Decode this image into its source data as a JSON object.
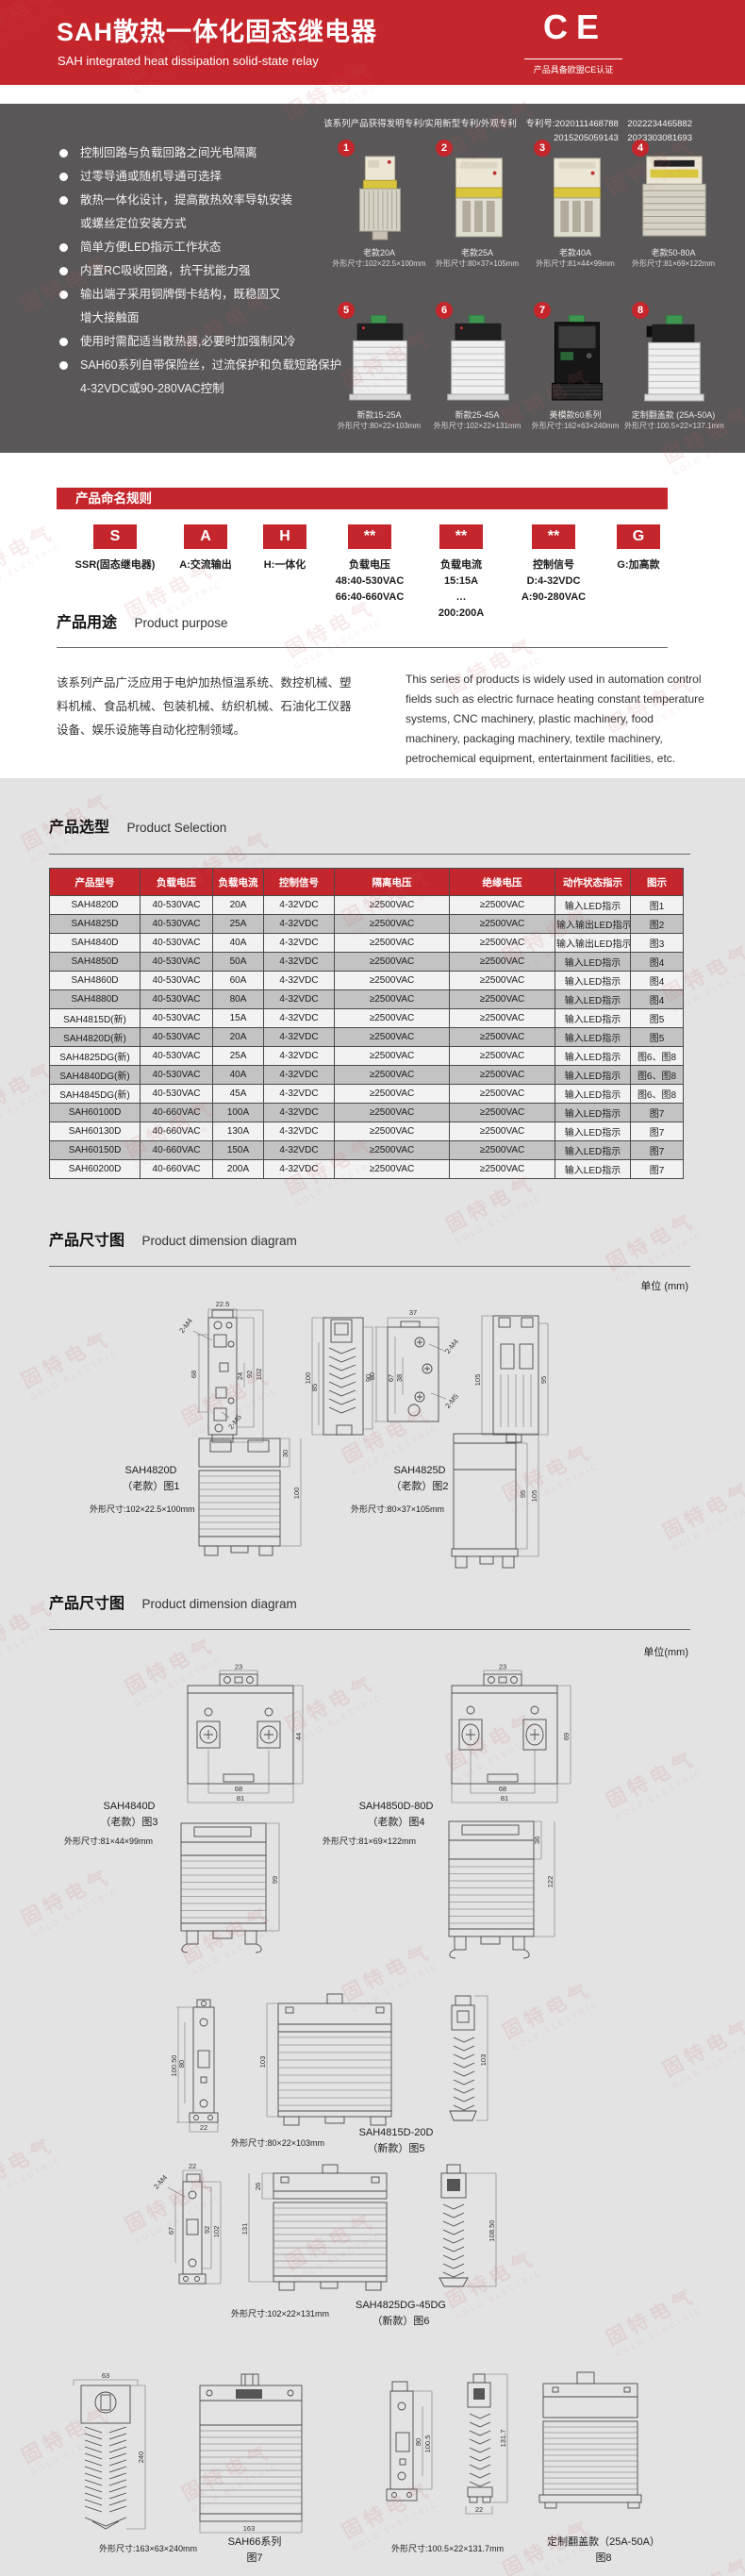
{
  "accent_color": "#c4262c",
  "dark_color": "#595757",
  "watermark": {
    "zh": "固特电气",
    "en": "GOLD ELECTRIC"
  },
  "header": {
    "title": "SAH散热一体化固态继电器",
    "subtitle": "SAH integrated heat dissipation solid-state relay",
    "ce_mark": "CE",
    "ce_note": "产品具备欧盟CE认证"
  },
  "features": {
    "patent_line1": "该系列产品获得发明专利/实用新型专利/外观专利　专利号:2020111468788　2022234465882",
    "patent_line2": "2015205059143　2023303081693",
    "lines": [
      {
        "bullet": true,
        "text": "控制回路与负载回路之间光电隔离"
      },
      {
        "bullet": true,
        "text": "过零导通或随机导通可选择"
      },
      {
        "bullet": true,
        "text": "散热一体化设计，提高散热效率导轨安装"
      },
      {
        "bullet": false,
        "text": "或螺丝定位安装方式"
      },
      {
        "bullet": true,
        "text": "简单方便LED指示工作状态"
      },
      {
        "bullet": true,
        "text": "内置RC吸收回路，抗干扰能力强"
      },
      {
        "bullet": true,
        "text": "输出端子采用铜牌倒卡结构，既稳固又"
      },
      {
        "bullet": false,
        "text": "增大接触面"
      },
      {
        "bullet": true,
        "text": "使用时需配适当散热器,必要时加强制风冷"
      },
      {
        "bullet": true,
        "text": "SAH60系列自带保险丝，过流保护和负载短路保护"
      },
      {
        "bullet": false,
        "text": "4-32VDC或90-280VAC控制"
      }
    ],
    "products": [
      {
        "num": "1",
        "name": "老款20A",
        "size": "外形尺寸:102×22.5×100mm",
        "image": "old-narrow-relay"
      },
      {
        "num": "2",
        "name": "老款25A",
        "size": "外形尺寸:80×37×105mm",
        "image": "old-box-relay"
      },
      {
        "num": "3",
        "name": "老款40A",
        "size": "外形尺寸:81×44×99mm",
        "image": "old-box-relay"
      },
      {
        "num": "4",
        "name": "老款50-80A",
        "size": "外形尺寸:81×69×122mm",
        "image": "old-wide-relay"
      },
      {
        "num": "5",
        "name": "新款15-25A",
        "size": "外形尺寸:80×22×103mm",
        "image": "new-fin-relay"
      },
      {
        "num": "6",
        "name": "新款25-45A",
        "size": "外形尺寸:102×22×131mm",
        "image": "new-fin-relay"
      },
      {
        "num": "7",
        "name": "美模款60系列",
        "size": "外形尺寸:162×63×240mm",
        "image": "module-relay"
      },
      {
        "num": "8",
        "name": "定制翻盖款 (25A-50A)",
        "size": "外形尺寸:100.5×22×137.1mm",
        "image": "flip-relay"
      }
    ]
  },
  "naming": {
    "banner": "产品命名规则",
    "parts": [
      {
        "code": "S",
        "lines": [
          "SSR(固态继电器)"
        ]
      },
      {
        "code": "A",
        "lines": [
          "A:交流输出"
        ]
      },
      {
        "code": "H",
        "lines": [
          "H:一体化"
        ]
      },
      {
        "code": "**",
        "lines": [
          "负载电压",
          "48:40-530VAC",
          "66:40-660VAC"
        ]
      },
      {
        "code": "**",
        "lines": [
          "负载电流",
          "15:15A",
          "…",
          "200:200A"
        ]
      },
      {
        "code": "**",
        "lines": [
          "控制信号",
          "D:4-32VDC",
          "A:90-280VAC"
        ]
      },
      {
        "code": "G",
        "lines": [
          "G:加高款"
        ]
      }
    ]
  },
  "purpose": {
    "title_zh": "产品用途",
    "title_en": "Product purpose",
    "text_zh": "该系列产品广泛应用于电炉加热恒温系统、数控机械、塑料机械、食品机械、包装机械、纺织机械、石油化工仪器设备、娱乐设施等自动化控制领域。",
    "text_en": "This series of products is widely used in automation control fields such as electric furnace heating constant temperature systems, CNC machinery, plastic machinery, food machinery, packaging machinery, textile machinery, petrochemical equipment, entertainment facilities, etc."
  },
  "selection": {
    "title_zh": "产品选型",
    "title_en": "Product Selection",
    "headers": [
      "产品型号",
      "负载电压",
      "负载电流",
      "控制信号",
      "隔离电压",
      "绝缘电压",
      "动作状态指示",
      "图示"
    ],
    "rows": [
      [
        "SAH4820D",
        "40-530VAC",
        "20A",
        "4-32VDC",
        "≥2500VAC",
        "≥2500VAC",
        "输入LED指示",
        "图1"
      ],
      [
        "SAH4825D",
        "40-530VAC",
        "25A",
        "4-32VDC",
        "≥2500VAC",
        "≥2500VAC",
        "输入输出LED指示",
        "图2"
      ],
      [
        "SAH4840D",
        "40-530VAC",
        "40A",
        "4-32VDC",
        "≥2500VAC",
        "≥2500VAC",
        "输入输出LED指示",
        "图3"
      ],
      [
        "SAH4850D",
        "40-530VAC",
        "50A",
        "4-32VDC",
        "≥2500VAC",
        "≥2500VAC",
        "输入LED指示",
        "图4"
      ],
      [
        "SAH4860D",
        "40-530VAC",
        "60A",
        "4-32VDC",
        "≥2500VAC",
        "≥2500VAC",
        "输入LED指示",
        "图4"
      ],
      [
        "SAH4880D",
        "40-530VAC",
        "80A",
        "4-32VDC",
        "≥2500VAC",
        "≥2500VAC",
        "输入LED指示",
        "图4"
      ],
      [
        "SAH4815D(新)",
        "40-530VAC",
        "15A",
        "4-32VDC",
        "≥2500VAC",
        "≥2500VAC",
        "输入LED指示",
        "图5"
      ],
      [
        "SAH4820D(新)",
        "40-530VAC",
        "20A",
        "4-32VDC",
        "≥2500VAC",
        "≥2500VAC",
        "输入LED指示",
        "图5"
      ],
      [
        "SAH4825DG(新)",
        "40-530VAC",
        "25A",
        "4-32VDC",
        "≥2500VAC",
        "≥2500VAC",
        "输入LED指示",
        "图6、图8"
      ],
      [
        "SAH4840DG(新)",
        "40-530VAC",
        "40A",
        "4-32VDC",
        "≥2500VAC",
        "≥2500VAC",
        "输入LED指示",
        "图6、图8"
      ],
      [
        "SAH4845DG(新)",
        "40-530VAC",
        "45A",
        "4-32VDC",
        "≥2500VAC",
        "≥2500VAC",
        "输入LED指示",
        "图6、图8"
      ],
      [
        "SAH60100D",
        "40-660VAC",
        "100A",
        "4-32VDC",
        "≥2500VAC",
        "≥2500VAC",
        "输入LED指示",
        "图7"
      ],
      [
        "SAH60130D",
        "40-660VAC",
        "130A",
        "4-32VDC",
        "≥2500VAC",
        "≥2500VAC",
        "输入LED指示",
        "图7"
      ],
      [
        "SAH60150D",
        "40-660VAC",
        "150A",
        "4-32VDC",
        "≥2500VAC",
        "≥2500VAC",
        "输入LED指示",
        "图7"
      ],
      [
        "SAH60200D",
        "40-660VAC",
        "200A",
        "4-32VDC",
        "≥2500VAC",
        "≥2500VAC",
        "输入LED指示",
        "图7"
      ]
    ]
  },
  "dims1": {
    "title_zh": "产品尺寸图",
    "title_en": "Product dimension diagram",
    "unit": "单位 (mm)",
    "fig1": {
      "model": "SAH4820D",
      "variant": "（老款）图1",
      "size": "外形尺寸:102×22.5×100mm",
      "labels": [
        "22.5",
        "2-M4",
        "68",
        "24",
        "92",
        "102",
        "2-M5",
        "100",
        "85",
        "90",
        "30",
        "100"
      ]
    },
    "fig2": {
      "model": "SAH4825D",
      "variant": "（老款）图2",
      "size": "外形尺寸:80×37×105mm",
      "labels": [
        "37",
        "2-M4",
        "80",
        "67",
        "38",
        "2-M5",
        "105",
        "95",
        "95",
        "105"
      ]
    }
  },
  "dims2": {
    "title_zh": "产品尺寸图",
    "title_en": "Product dimension diagram",
    "unit": "单位(mm)",
    "fig3": {
      "model": "SAH4840D",
      "variant": "（老款）图3",
      "size": "外形尺寸:81×44×99mm",
      "labels": [
        "23",
        "44",
        "68",
        "81",
        "99"
      ]
    },
    "fig4": {
      "model": "SAH4850D-80D",
      "variant": "（老款）图4",
      "size": "外形尺寸:81×69×122mm",
      "labels": [
        "23",
        "69",
        "68",
        "81",
        "36",
        "122"
      ]
    },
    "fig5": {
      "model": "SAH4815D-20D",
      "variant": "（新款）图5",
      "size": "外形尺寸:80×22×103mm",
      "labels": [
        "100.50",
        "80",
        "22",
        "103",
        "103"
      ]
    },
    "fig6": {
      "model": "SAH4825DG-45DG",
      "variant": "（新款）图6",
      "size": "外形尺寸:102×22×131mm",
      "labels": [
        "22",
        "2-M4",
        "67",
        "92",
        "102",
        "26",
        "131",
        "108.50"
      ]
    },
    "fig7": {
      "model": "SAH66系列",
      "variant": "图7",
      "size": "外形尺寸:163×63×240mm",
      "labels": [
        "63",
        "240",
        "163"
      ]
    },
    "fig8": {
      "model": "定制翻盖款（25A-50A）",
      "variant": "图8",
      "size": "外形尺寸:100.5×22×131.7mm",
      "labels": [
        "80",
        "100.5",
        "131.7",
        "22"
      ]
    }
  }
}
